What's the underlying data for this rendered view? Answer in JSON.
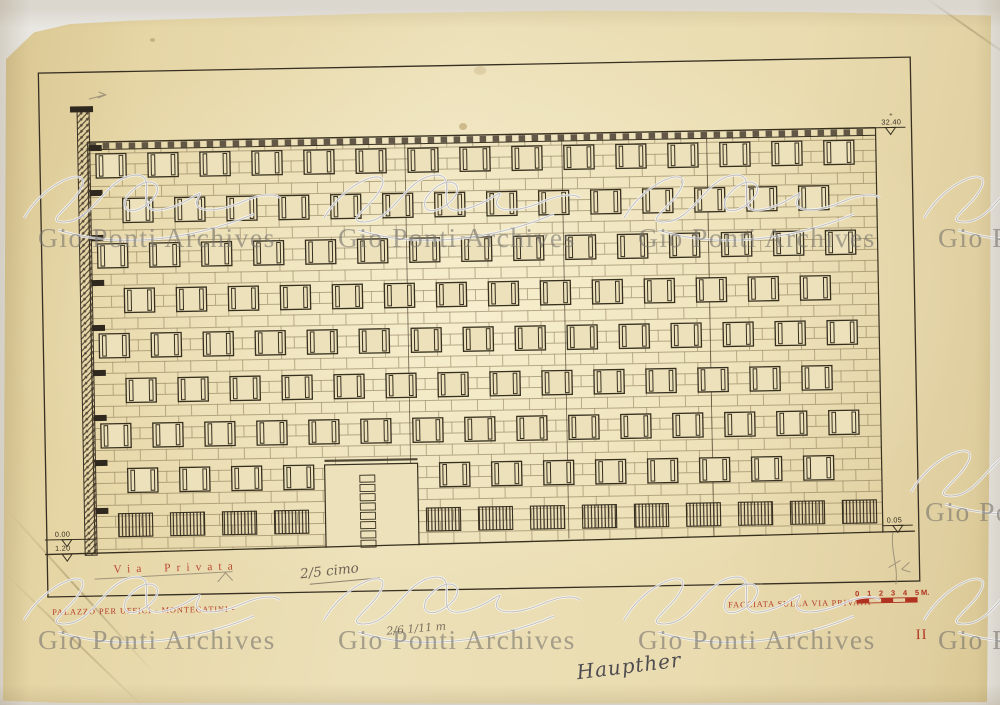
{
  "sheet": {
    "project_title": "PALAZZO PER UFFICI - MONTECATINI -",
    "drawing_title": "FACCIATA SULLA VIA PRIVATA",
    "sheet_number": "II",
    "street_name": "Via Privata"
  },
  "levels": {
    "parapet": "32.40",
    "parapet_plus": "+",
    "street_right": "0.05",
    "zero": "0.00",
    "street_left": "1.20"
  },
  "scale_bar": {
    "ticks": [
      "0",
      "1",
      "2",
      "3",
      "4",
      "5"
    ],
    "unit": "M."
  },
  "handwritten": {
    "pencil_note": "2/5 cimo",
    "pencil_fractions": "2/6 1/11 m",
    "ink_note": "Haupther"
  },
  "watermark": {
    "text": "Gio Ponti Archives",
    "placements": [
      [
        38,
        224
      ],
      [
        338,
        224
      ],
      [
        638,
        224
      ],
      [
        938,
        224
      ],
      [
        38,
        626
      ],
      [
        338,
        626
      ],
      [
        638,
        626
      ],
      [
        938,
        626
      ],
      [
        925,
        498
      ]
    ]
  },
  "facade": {
    "floors": 8,
    "columns_even": 15,
    "columns_odd": 14,
    "vents_left": 4,
    "vents_right": 9,
    "has_entrance_door": true
  },
  "colors": {
    "paper": "#ece1bb",
    "ink": "#37301f",
    "brick": "#8b7b57",
    "red": "#b03220",
    "pencil": "#6f6455",
    "watermark": "#8f8d88"
  }
}
